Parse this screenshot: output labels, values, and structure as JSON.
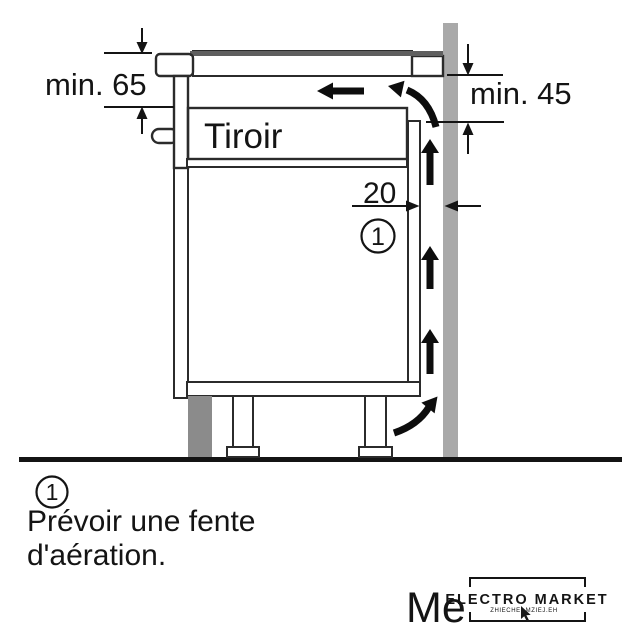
{
  "diagram": {
    "dim_top_left": "min. 65",
    "dim_right": "min. 45",
    "dim_gap": "20",
    "drawer_label": "Tiroir",
    "callout_number": "1"
  },
  "note": {
    "number": "1",
    "text_line1": "Prévoir une fente",
    "text_line2": "d'aération."
  },
  "watermark": {
    "partial_text": "Me",
    "logo_title": "ELECTRO MARKET",
    "logo_subtitle": "ZHIECHEI-MZIEJ.EH"
  },
  "colors": {
    "wall": "#a9a9a9",
    "panel": "#d8d8d8",
    "drawer": "#e4e4e4",
    "plinth": "#8b8b8b",
    "hob_top": "#5f5f5f",
    "line": "#141414"
  }
}
